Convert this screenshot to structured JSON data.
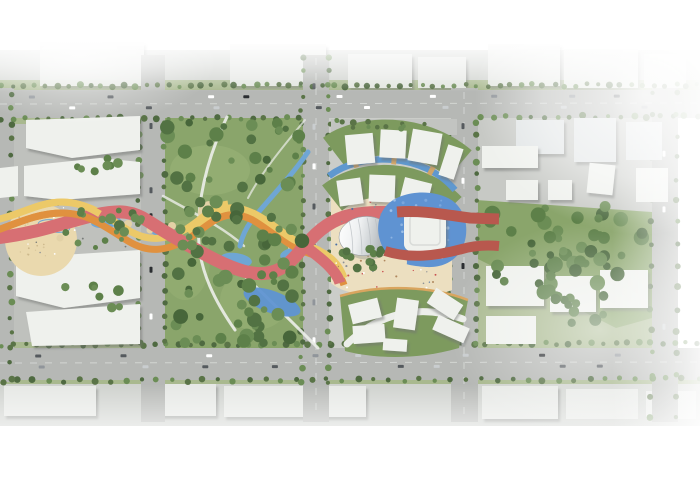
{
  "meta": {
    "description": "Aerial master-plan rendering of an urban design site: central civic plaza with dome pavilion and sunken pool, flanking city blocks, two parks, and red-orange-yellow ribbon walkways weaving east-west",
    "visible_text": "none"
  },
  "palette": {
    "page_bg": "#ffffff",
    "ground": "#cfd2ce",
    "ground_west": "#bfc1bd",
    "ground_center": "#cbcdc9",
    "ground_east": "#c7c9c5",
    "road": "#b6b8b5",
    "lane_line": "#dadcd9",
    "lawn": "#a9b98f",
    "park_green": "#8aa56b",
    "park_light": "#9ab377",
    "tree_dark": "#47663a",
    "tree_mid": "#5d8049",
    "tree_light": "#6b8d55",
    "tree_line": "#5a7447",
    "building_white": "#eff1ed",
    "building_faded": "#e9ebe8",
    "building_pale_blue": "#dfe3e4",
    "path_white": "#eceeea",
    "plaza_sand": "#ecdfc0",
    "plaza_circle": "#ead9ae",
    "tan_circle": "#e2d1a6",
    "podium_green": "#7d9a5e",
    "podium_trim": "#d9a55f",
    "canal_blue": "#5f98cf",
    "pool_blue": "#5f93d2",
    "stream_blue": "#6fa6d4",
    "ribbon_red": "#d76f73",
    "ribbon_red_dark": "#b8584e",
    "ribbon_orange": "#e0913f",
    "ribbon_yellow": "#ecc968",
    "dome_hi": "#ffffff",
    "dome_lo": "#a6abb0",
    "dome_line": "#b9bec2",
    "shadow": "#6f726f",
    "white": "#ffffff"
  },
  "scatter": {
    "clusters": [
      {
        "id": "park_trees",
        "x": 166,
        "y": 122,
        "w": 136,
        "h": 222,
        "count": 95,
        "rmin": 3,
        "rmax": 7.5,
        "seed": 7,
        "colors": [
          "#47663a",
          "#5d8049",
          "#6b8d55",
          "#527243"
        ]
      },
      {
        "id": "right_trees",
        "x": 482,
        "y": 206,
        "w": 164,
        "h": 92,
        "count": 50,
        "rmin": 3.5,
        "rmax": 8,
        "seed": 11,
        "colors": [
          "#47663a",
          "#5d8049",
          "#6b8d55"
        ]
      },
      {
        "id": "right_trees2",
        "x": 540,
        "y": 296,
        "w": 104,
        "h": 30,
        "count": 12,
        "rmin": 3,
        "rmax": 6,
        "seed": 12,
        "colors": [
          "#527243",
          "#5d8049"
        ]
      },
      {
        "id": "corridor_tufts",
        "x": 58,
        "y": 210,
        "w": 92,
        "h": 38,
        "count": 12,
        "rmin": 2,
        "rmax": 4,
        "seed": 5,
        "colors": [
          "#5d8049",
          "#6b8d55"
        ]
      },
      {
        "id": "left_trees1",
        "x": 60,
        "y": 158,
        "w": 66,
        "h": 16,
        "count": 7,
        "rmin": 3,
        "rmax": 5,
        "seed": 3,
        "colors": [
          "#5d8049",
          "#6b8d55"
        ]
      },
      {
        "id": "left_trees2",
        "x": 92,
        "y": 202,
        "w": 44,
        "h": 34,
        "count": 6,
        "rmin": 3.5,
        "rmax": 6,
        "seed": 4,
        "colors": [
          "#527243",
          "#6b8d55"
        ]
      },
      {
        "id": "left_trees3",
        "x": 64,
        "y": 286,
        "w": 56,
        "h": 22,
        "count": 7,
        "rmin": 3,
        "rmax": 5.5,
        "seed": 6,
        "colors": [
          "#5d8049",
          "#6b8d55"
        ]
      },
      {
        "id": "plaza_tree_row",
        "x": 336,
        "y": 244,
        "w": 52,
        "h": 14,
        "count": 9,
        "rmin": 3.5,
        "rmax": 4.5,
        "seed": 9,
        "colors": [
          "#527243",
          "#5d8049"
        ]
      },
      {
        "id": "dome_south_trees",
        "x": 356,
        "y": 258,
        "w": 34,
        "h": 10,
        "count": 4,
        "rmin": 3.5,
        "rmax": 4.5,
        "seed": 10,
        "colors": [
          "#527243",
          "#5d8049"
        ]
      },
      {
        "id": "arc_verge_trees",
        "x": 332,
        "y": 120,
        "w": 124,
        "h": 10,
        "count": 13,
        "rmin": 2,
        "rmax": 3.5,
        "seed": 13,
        "colors": [
          "#5a7447",
          "#6b8d55"
        ]
      },
      {
        "id": "pool_texture",
        "x": 388,
        "y": 200,
        "w": 70,
        "h": 58,
        "count": 45,
        "rmin": 0.8,
        "rmax": 1.6,
        "seed": 14,
        "colors": [
          "#8db4e2",
          "#7aa6dc",
          "#9cc0e8"
        ]
      },
      {
        "id": "plaza_people",
        "x": 336,
        "y": 200,
        "w": 112,
        "h": 92,
        "count": 70,
        "rmin": 0.6,
        "rmax": 1.1,
        "seed": 15,
        "colors": [
          "#8d9196",
          "#b0885f",
          "#c94f4f",
          "#4a6fa5",
          "#ffffff"
        ]
      },
      {
        "id": "corridor_people",
        "x": 18,
        "y": 204,
        "w": 118,
        "h": 52,
        "count": 26,
        "rmin": 0.6,
        "rmax": 1,
        "seed": 16,
        "colors": [
          "#8d9196",
          "#777b78",
          "#ffffff"
        ]
      },
      {
        "id": "circle_texture",
        "x": 16,
        "y": 214,
        "w": 50,
        "h": 50,
        "count": 18,
        "rmin": 0.6,
        "rmax": 1,
        "seed": 17,
        "colors": [
          "#cdb98c",
          "#d8c69a"
        ]
      }
    ],
    "tree_lines": [
      {
        "x1": 2,
        "y1": 86,
        "x2": 698,
        "y2": 85,
        "count": 64
      },
      {
        "x1": 2,
        "y1": 119,
        "x2": 300,
        "y2": 118,
        "count": 26
      },
      {
        "x1": 480,
        "y1": 117,
        "x2": 698,
        "y2": 116,
        "count": 18
      },
      {
        "x1": 2,
        "y1": 345,
        "x2": 698,
        "y2": 343,
        "count": 60
      },
      {
        "x1": 2,
        "y1": 381,
        "x2": 698,
        "y2": 379,
        "count": 46
      },
      {
        "x1": 139,
        "y1": 122,
        "x2": 139,
        "y2": 342,
        "count": 18
      },
      {
        "x1": 165,
        "y1": 122,
        "x2": 165,
        "y2": 342,
        "count": 18
      },
      {
        "x1": 302,
        "y1": 58,
        "x2": 302,
        "y2": 382,
        "count": 26
      },
      {
        "x1": 329,
        "y1": 58,
        "x2": 329,
        "y2": 382,
        "count": 26
      },
      {
        "x1": 449,
        "y1": 122,
        "x2": 449,
        "y2": 344,
        "count": 18
      },
      {
        "x1": 477,
        "y1": 122,
        "x2": 477,
        "y2": 344,
        "count": 18
      },
      {
        "x1": 651,
        "y1": 92,
        "x2": 651,
        "y2": 418,
        "count": 16
      },
      {
        "x1": 677,
        "y1": 92,
        "x2": 677,
        "y2": 418,
        "count": 16
      },
      {
        "x1": 11,
        "y1": 94,
        "x2": 11,
        "y2": 378,
        "count": 20
      }
    ],
    "tree_line_style": {
      "rmin": 2,
      "rmax": 3.5,
      "jitter": 1.5,
      "colors": [
        "#5a7447",
        "#4f6a41",
        "#6b8d55"
      ]
    },
    "car_lines": [
      {
        "x1": 20,
        "y1": 97,
        "x2": 690,
        "y2": 96,
        "count": 9,
        "vertical": false
      },
      {
        "x1": 30,
        "y1": 108,
        "x2": 680,
        "y2": 107,
        "count": 8,
        "vertical": false
      },
      {
        "x1": 20,
        "y1": 356,
        "x2": 690,
        "y2": 355,
        "count": 8,
        "vertical": false
      },
      {
        "x1": 30,
        "y1": 367,
        "x2": 680,
        "y2": 366,
        "count": 8,
        "vertical": false
      },
      {
        "x1": 314,
        "y1": 60,
        "x2": 314,
        "y2": 380,
        "count": 7,
        "vertical": true
      },
      {
        "x1": 463,
        "y1": 125,
        "x2": 463,
        "y2": 380,
        "count": 6,
        "vertical": true
      },
      {
        "x1": 151,
        "y1": 125,
        "x2": 151,
        "y2": 340,
        "count": 5,
        "vertical": true
      },
      {
        "x1": 664,
        "y1": 100,
        "x2": 664,
        "y2": 410,
        "count": 3,
        "vertical": true
      },
      {
        "x1": 336,
        "y1": 128,
        "x2": 450,
        "y2": 127,
        "count": 12,
        "vertical": false
      }
    ],
    "car_colors": [
      "#ffffff",
      "#2b2e31",
      "#c9cdcf",
      "#90959a",
      "#555a5e"
    ]
  }
}
